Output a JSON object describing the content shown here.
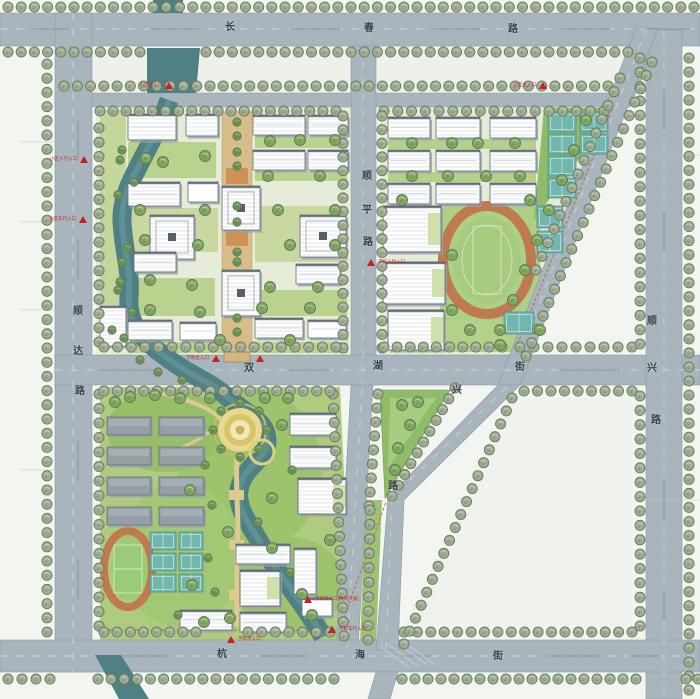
{
  "plan": {
    "title": "居住区规划总平面图",
    "roads": {
      "changchun": {
        "name": "长春路",
        "chars": [
          "长",
          "春",
          "路"
        ]
      },
      "shunda": {
        "name": "顺达路",
        "chars": [
          "顺",
          "达",
          "路"
        ]
      },
      "shunping": {
        "name": "顺平路",
        "chars": [
          "顺",
          "平",
          "路"
        ]
      },
      "shuanghu": {
        "name": "双湖街",
        "chars": [
          "双",
          "湖",
          "街"
        ]
      },
      "shunxing": {
        "name": "顺兴路",
        "chars": [
          "顺",
          "兴",
          "路"
        ]
      },
      "huxing": {
        "name": "湖兴路",
        "chars": [
          "兴",
          "路"
        ]
      },
      "hanghai": {
        "name": "杭海街",
        "chars": [
          "杭",
          "海",
          "街"
        ]
      }
    },
    "entrances": [
      {
        "label": "小区主入口"
      },
      {
        "label": "小区人行入口"
      },
      {
        "label": "小区车行入口"
      },
      {
        "label": "小区主入口"
      },
      {
        "label": "学校人行入口"
      },
      {
        "label": "学校主入口"
      },
      {
        "label": ""
      },
      {
        "label": "学校次入口(晚间开放)"
      },
      {
        "label": "学校次入口"
      },
      {
        "label": "学校车行入口"
      }
    ],
    "colors": {
      "road": "#a9b5bd",
      "road_edge": "#8b99a4",
      "water": "#4f8084",
      "street_tree": "#9dab90",
      "park_tree": "#7fa75e",
      "track_orange": "#bf7a4f",
      "infield_green": "#a7cc80",
      "court_teal": "#72b7ad",
      "building_white": "#fdfdfe",
      "dorm_gray": "#969ea6",
      "axis_tan": "#d6bd89",
      "marker_red": "#c81f1f"
    }
  }
}
